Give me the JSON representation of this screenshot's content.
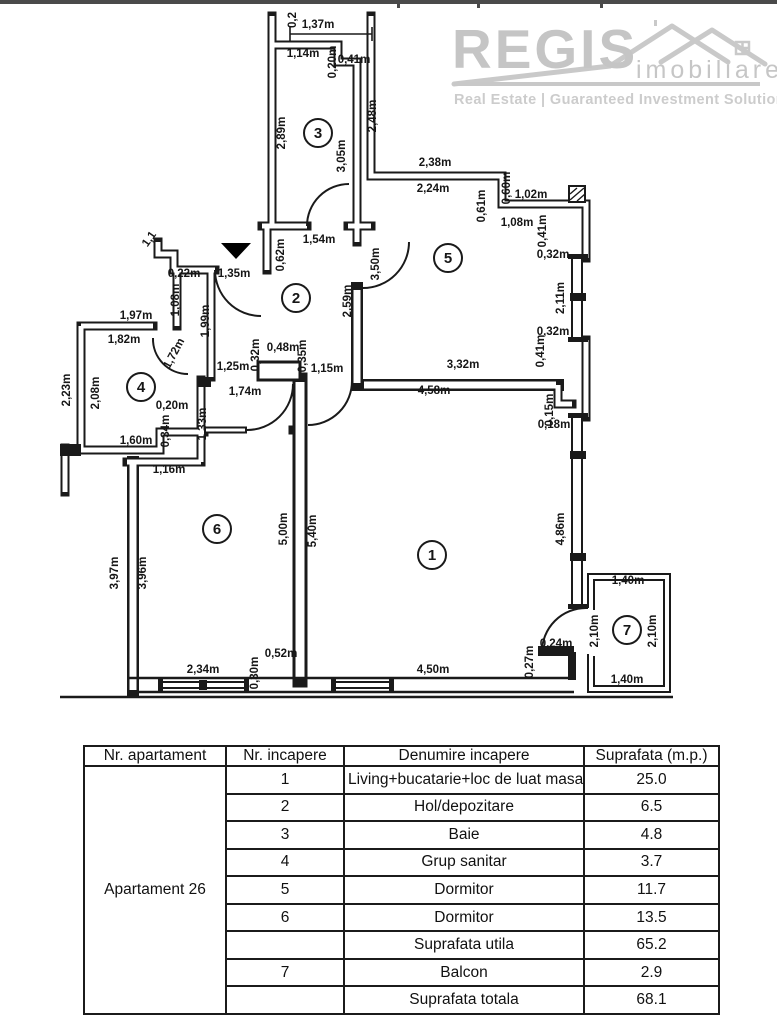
{
  "logo": {
    "brand": "REGIS",
    "brand_sub": "imobiliare",
    "tagline": "Real Estate | Guaranteed Investment Solutions",
    "color": "#c6c6c6"
  },
  "plan": {
    "rooms": [
      {
        "number": "1",
        "x": 432,
        "y": 555
      },
      {
        "number": "2",
        "x": 296,
        "y": 298
      },
      {
        "number": "3",
        "x": 318,
        "y": 133
      },
      {
        "number": "4",
        "x": 141,
        "y": 387
      },
      {
        "number": "5",
        "x": 448,
        "y": 258
      },
      {
        "number": "6",
        "x": 217,
        "y": 529
      },
      {
        "number": "7",
        "x": 627,
        "y": 630
      }
    ],
    "labels": [
      {
        "t": "1,37m",
        "x": 318,
        "y": 28,
        "r": 0
      },
      {
        "t": "0,2",
        "x": 296,
        "y": 20,
        "r": -90
      },
      {
        "t": "1,14m",
        "x": 303,
        "y": 57,
        "r": 0
      },
      {
        "t": "0,20m",
        "x": 336,
        "y": 62,
        "r": -90
      },
      {
        "t": "0,41m",
        "x": 354,
        "y": 63,
        "r": 0
      },
      {
        "t": "2,89m",
        "x": 285,
        "y": 133,
        "r": -90
      },
      {
        "t": "3,05m",
        "x": 345,
        "y": 156,
        "r": -90
      },
      {
        "t": "2,48m",
        "x": 376,
        "y": 116,
        "r": -90
      },
      {
        "t": "2,38m",
        "x": 435,
        "y": 166,
        "r": 0
      },
      {
        "t": "2,24m",
        "x": 433,
        "y": 192,
        "r": 0
      },
      {
        "t": "0,60m",
        "x": 510,
        "y": 188,
        "r": -90
      },
      {
        "t": "1,02m",
        "x": 531,
        "y": 198,
        "r": 0
      },
      {
        "t": "0,61m",
        "x": 485,
        "y": 206,
        "r": -90
      },
      {
        "t": "1,08m",
        "x": 517,
        "y": 226,
        "r": 0
      },
      {
        "t": "0,41m",
        "x": 546,
        "y": 231,
        "r": -90
      },
      {
        "t": "0,32m",
        "x": 553,
        "y": 258,
        "r": 0
      },
      {
        "t": "2,11m",
        "x": 564,
        "y": 298,
        "r": -90
      },
      {
        "t": "0,32m",
        "x": 553,
        "y": 335,
        "r": 0
      },
      {
        "t": "0,41m",
        "x": 544,
        "y": 351,
        "r": -90
      },
      {
        "t": "3,32m",
        "x": 463,
        "y": 368,
        "r": 0
      },
      {
        "t": "3,50m",
        "x": 379,
        "y": 264,
        "r": -90
      },
      {
        "t": "2,59m",
        "x": 351,
        "y": 301,
        "r": -90
      },
      {
        "t": "1,54m",
        "x": 319,
        "y": 243,
        "r": 0
      },
      {
        "t": "0,62m",
        "x": 284,
        "y": 255,
        "r": -90
      },
      {
        "t": "1,35m",
        "x": 234,
        "y": 277,
        "r": 0
      },
      {
        "t": "0,22m",
        "x": 184,
        "y": 277,
        "r": 0
      },
      {
        "t": "1,08m",
        "x": 179,
        "y": 300,
        "r": -90
      },
      {
        "t": "1,99m",
        "x": 209,
        "y": 321,
        "r": -90
      },
      {
        "t": "1,1",
        "x": 152,
        "y": 241,
        "r": -55
      },
      {
        "t": "1,97m",
        "x": 136,
        "y": 319,
        "r": 0
      },
      {
        "t": "1,82m",
        "x": 124,
        "y": 343,
        "r": 0
      },
      {
        "t": "1,72m",
        "x": 177,
        "y": 355,
        "r": -62
      },
      {
        "t": "2,23m",
        "x": 70,
        "y": 390,
        "r": -90
      },
      {
        "t": "2,08m",
        "x": 99,
        "y": 393,
        "r": -90
      },
      {
        "t": "0,32m",
        "x": 259,
        "y": 355,
        "r": -90
      },
      {
        "t": "0,48m",
        "x": 283,
        "y": 351,
        "r": 0
      },
      {
        "t": "0,35m",
        "x": 306,
        "y": 356,
        "r": -90
      },
      {
        "t": "1,25m",
        "x": 233,
        "y": 370,
        "r": 0
      },
      {
        "t": "1,15m",
        "x": 327,
        "y": 372,
        "r": 0
      },
      {
        "t": "1,74m",
        "x": 245,
        "y": 395,
        "r": 0
      },
      {
        "t": "0,20m",
        "x": 172,
        "y": 409,
        "r": 0
      },
      {
        "t": "0,34m",
        "x": 169,
        "y": 431,
        "r": -90
      },
      {
        "t": "1,60m",
        "x": 136,
        "y": 444,
        "r": 0
      },
      {
        "t": "1,33m",
        "x": 206,
        "y": 424,
        "r": -90
      },
      {
        "t": "1,16m",
        "x": 169,
        "y": 473,
        "r": 0
      },
      {
        "t": "3,97m",
        "x": 118,
        "y": 573,
        "r": -90
      },
      {
        "t": "3,96m",
        "x": 146,
        "y": 573,
        "r": -90
      },
      {
        "t": "5,00m",
        "x": 287,
        "y": 529,
        "r": -90
      },
      {
        "t": "5,40m",
        "x": 316,
        "y": 531,
        "r": -90
      },
      {
        "t": "2,34m",
        "x": 203,
        "y": 673,
        "r": 0
      },
      {
        "t": "0,52m",
        "x": 281,
        "y": 657,
        "r": 0
      },
      {
        "t": "0,30m",
        "x": 258,
        "y": 673,
        "r": -90
      },
      {
        "t": "4,58m",
        "x": 434,
        "y": 394,
        "r": 0
      },
      {
        "t": "0,15m",
        "x": 553,
        "y": 410,
        "r": -90
      },
      {
        "t": "0,18m",
        "x": 554,
        "y": 428,
        "r": 0
      },
      {
        "t": "4,86m",
        "x": 564,
        "y": 529,
        "r": -90
      },
      {
        "t": "0,24m",
        "x": 556,
        "y": 647,
        "r": 0
      },
      {
        "t": "0,27m",
        "x": 533,
        "y": 662,
        "r": -90
      },
      {
        "t": "4,50m",
        "x": 433,
        "y": 673,
        "r": 0
      },
      {
        "t": "1,40m",
        "x": 628,
        "y": 584,
        "r": 0
      },
      {
        "t": "2,10m",
        "x": 598,
        "y": 631,
        "r": -90
      },
      {
        "t": "2,10m",
        "x": 656,
        "y": 631,
        "r": -90
      },
      {
        "t": "1,40m",
        "x": 627,
        "y": 683,
        "r": 0
      }
    ]
  },
  "table": {
    "headers": [
      "Nr. apartament",
      "Nr. incapere",
      "Denumire incapere",
      "Suprafata (m.p.)"
    ],
    "apartment_label": "Apartament 26",
    "rows": [
      {
        "nr": "1",
        "name": "Living+bucatarie+loc de luat masa",
        "area": "25.0"
      },
      {
        "nr": "2",
        "name": "Hol/depozitare",
        "area": "6.5"
      },
      {
        "nr": "3",
        "name": "Baie",
        "area": "4.8"
      },
      {
        "nr": "4",
        "name": "Grup sanitar",
        "area": "3.7"
      },
      {
        "nr": "5",
        "name": "Dormitor",
        "area": "11.7"
      },
      {
        "nr": "6",
        "name": "Dormitor",
        "area": "13.5"
      },
      {
        "nr": "",
        "name": "Suprafata utila",
        "area": "65.2"
      },
      {
        "nr": "7",
        "name": "Balcon",
        "area": "2.9"
      },
      {
        "nr": "",
        "name": "Suprafata totala",
        "area": "68.1"
      }
    ]
  }
}
